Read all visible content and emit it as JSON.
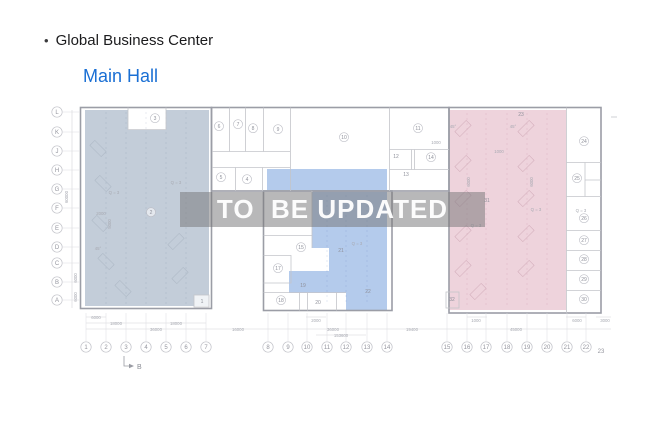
{
  "header": {
    "bullet": "•",
    "title": "Global Business Center",
    "subtitle": "Main Hall",
    "subtitle_color": "#1a6fd4"
  },
  "watermark": {
    "text": "TO  BE UPDATED"
  },
  "plan": {
    "colors": {
      "left_hall_fill": "#c3cdd9",
      "middle_fill": "#b4cbec",
      "right_fill": "#eed3dc",
      "outer_wall": "#9b9da6",
      "partition": "#c4c5ca",
      "grid_stroke": "#c2c3c9",
      "grid_text": "#94959e",
      "room_text": "#8f919b",
      "dim_text": "#a8aab2",
      "stall_left": "#aeb9c6",
      "stall_right": "#d4afbc"
    },
    "grid_rows": [
      {
        "label": "L",
        "y": 112
      },
      {
        "label": "K",
        "y": 132
      },
      {
        "label": "J",
        "y": 151
      },
      {
        "label": "H",
        "y": 170
      },
      {
        "label": "G",
        "y": 189
      },
      {
        "label": "F",
        "y": 208
      },
      {
        "label": "E",
        "y": 228
      },
      {
        "label": "D",
        "y": 247
      },
      {
        "label": "C",
        "y": 263
      },
      {
        "label": "B",
        "y": 282
      },
      {
        "label": "A",
        "y": 300
      }
    ],
    "grid_cols": [
      {
        "label": "1",
        "x": 86
      },
      {
        "label": "2",
        "x": 106
      },
      {
        "label": "3",
        "x": 126
      },
      {
        "label": "4",
        "x": 146
      },
      {
        "label": "5",
        "x": 166
      },
      {
        "label": "6",
        "x": 186
      },
      {
        "label": "7",
        "x": 206
      },
      {
        "label": "8",
        "x": 268
      },
      {
        "label": "9",
        "x": 288
      },
      {
        "label": "10",
        "x": 307
      },
      {
        "label": "11",
        "x": 327
      },
      {
        "label": "12",
        "x": 346
      },
      {
        "label": "13",
        "x": 367
      },
      {
        "label": "14",
        "x": 387
      },
      {
        "label": "15",
        "x": 447
      },
      {
        "label": "16",
        "x": 467
      },
      {
        "label": "17",
        "x": 486
      },
      {
        "label": "18",
        "x": 507
      },
      {
        "label": "19",
        "x": 527
      },
      {
        "label": "20",
        "x": 547
      },
      {
        "label": "21",
        "x": 567
      },
      {
        "label": "22",
        "x": 586
      },
      {
        "label": "23",
        "x": 601,
        "plain": true,
        "y": 353
      }
    ],
    "rooms": [
      {
        "n": "1",
        "x": 202,
        "y": 303,
        "kind": "box"
      },
      {
        "n": "2",
        "x": 151,
        "y": 214,
        "kind": "circle"
      },
      {
        "n": "3",
        "x": 155,
        "y": 120,
        "kind": "circle"
      },
      {
        "n": "4",
        "x": 247,
        "y": 181,
        "kind": "circle"
      },
      {
        "n": "5",
        "x": 221,
        "y": 179,
        "kind": "circle"
      },
      {
        "n": "6",
        "x": 219,
        "y": 128,
        "kind": "circle"
      },
      {
        "n": "7",
        "x": 238,
        "y": 126,
        "kind": "circle"
      },
      {
        "n": "8",
        "x": 253,
        "y": 130,
        "kind": "circle"
      },
      {
        "n": "9",
        "x": 278,
        "y": 131,
        "kind": "circle"
      },
      {
        "n": "10",
        "x": 344,
        "y": 139,
        "kind": "circle"
      },
      {
        "n": "11",
        "x": 418,
        "y": 130,
        "kind": "circle"
      },
      {
        "n": "12",
        "x": 396,
        "y": 158,
        "kind": "plain"
      },
      {
        "n": "13",
        "x": 406,
        "y": 176,
        "kind": "plain"
      },
      {
        "n": "14",
        "x": 431,
        "y": 159,
        "kind": "circle"
      },
      {
        "n": "15",
        "x": 301,
        "y": 249,
        "kind": "circle"
      },
      {
        "n": "17",
        "x": 278,
        "y": 270,
        "kind": "circle"
      },
      {
        "n": "18",
        "x": 281,
        "y": 302,
        "kind": "circle"
      },
      {
        "n": "19",
        "x": 303,
        "y": 287,
        "kind": "plain"
      },
      {
        "n": "20",
        "x": 318,
        "y": 304,
        "kind": "plain"
      },
      {
        "n": "21",
        "x": 341,
        "y": 252,
        "kind": "plain"
      },
      {
        "n": "22",
        "x": 368,
        "y": 293,
        "kind": "plain"
      },
      {
        "n": "23",
        "x": 521,
        "y": 116,
        "kind": "plain"
      },
      {
        "n": "24",
        "x": 584,
        "y": 143,
        "kind": "circle"
      },
      {
        "n": "25",
        "x": 577,
        "y": 180,
        "kind": "circle"
      },
      {
        "n": "26",
        "x": 584,
        "y": 220,
        "kind": "circle"
      },
      {
        "n": "27",
        "x": 584,
        "y": 242,
        "kind": "circle"
      },
      {
        "n": "28",
        "x": 584,
        "y": 261,
        "kind": "circle"
      },
      {
        "n": "29",
        "x": 584,
        "y": 281,
        "kind": "circle"
      },
      {
        "n": "30",
        "x": 584,
        "y": 301,
        "kind": "circle"
      },
      {
        "n": "31",
        "x": 487,
        "y": 202,
        "kind": "plain"
      },
      {
        "n": "32",
        "x": 452,
        "y": 301,
        "kind": "plain"
      }
    ],
    "inner_labels": [
      {
        "t": "Q = 3",
        "x": 114,
        "y": 194
      },
      {
        "t": "Q = 3",
        "x": 176,
        "y": 184
      },
      {
        "t": "2000",
        "x": 101,
        "y": 215
      },
      {
        "t": "5000",
        "x": 111,
        "y": 224,
        "rot": -90
      },
      {
        "t": "45°",
        "x": 98,
        "y": 250
      },
      {
        "t": "Q = 3",
        "x": 357,
        "y": 245
      },
      {
        "t": "45°",
        "x": 453,
        "y": 128
      },
      {
        "t": "45°",
        "x": 513,
        "y": 128
      },
      {
        "t": "1000",
        "x": 436,
        "y": 144
      },
      {
        "t": "1000",
        "x": 499,
        "y": 153
      },
      {
        "t": "6000",
        "x": 470,
        "y": 182,
        "rot": -90
      },
      {
        "t": "6000",
        "x": 533,
        "y": 182,
        "rot": -90
      },
      {
        "t": "Q = 3",
        "x": 536,
        "y": 211
      },
      {
        "t": "Q = 3",
        "x": 476,
        "y": 227
      },
      {
        "t": "Q = 3",
        "x": 581,
        "y": 212
      }
    ],
    "dims_bottom": [
      {
        "t": "6000",
        "x": 96,
        "y": 319
      },
      {
        "t": "18000",
        "x": 116,
        "y": 325
      },
      {
        "t": "36000",
        "x": 156,
        "y": 331
      },
      {
        "t": "18000",
        "x": 176,
        "y": 325
      },
      {
        "t": "16000",
        "x": 238,
        "y": 331
      },
      {
        "t": "2000",
        "x": 316,
        "y": 322
      },
      {
        "t": "36000",
        "x": 333,
        "y": 331
      },
      {
        "t": "153600",
        "x": 341,
        "y": 337
      },
      {
        "t": "19400",
        "x": 412,
        "y": 331
      },
      {
        "t": "45000",
        "x": 516,
        "y": 331
      },
      {
        "t": "1000",
        "x": 476,
        "y": 322
      },
      {
        "t": "6000",
        "x": 577,
        "y": 322
      },
      {
        "t": "3000",
        "x": 605,
        "y": 322
      }
    ],
    "dims_left": [
      {
        "t": "60000",
        "x": 68,
        "y": 197,
        "rot": -90
      },
      {
        "t": "6000",
        "x": 77,
        "y": 278,
        "rot": -90
      },
      {
        "t": "6000",
        "x": 77,
        "y": 297,
        "rot": -90
      }
    ],
    "section_marker": {
      "label": "B"
    }
  }
}
